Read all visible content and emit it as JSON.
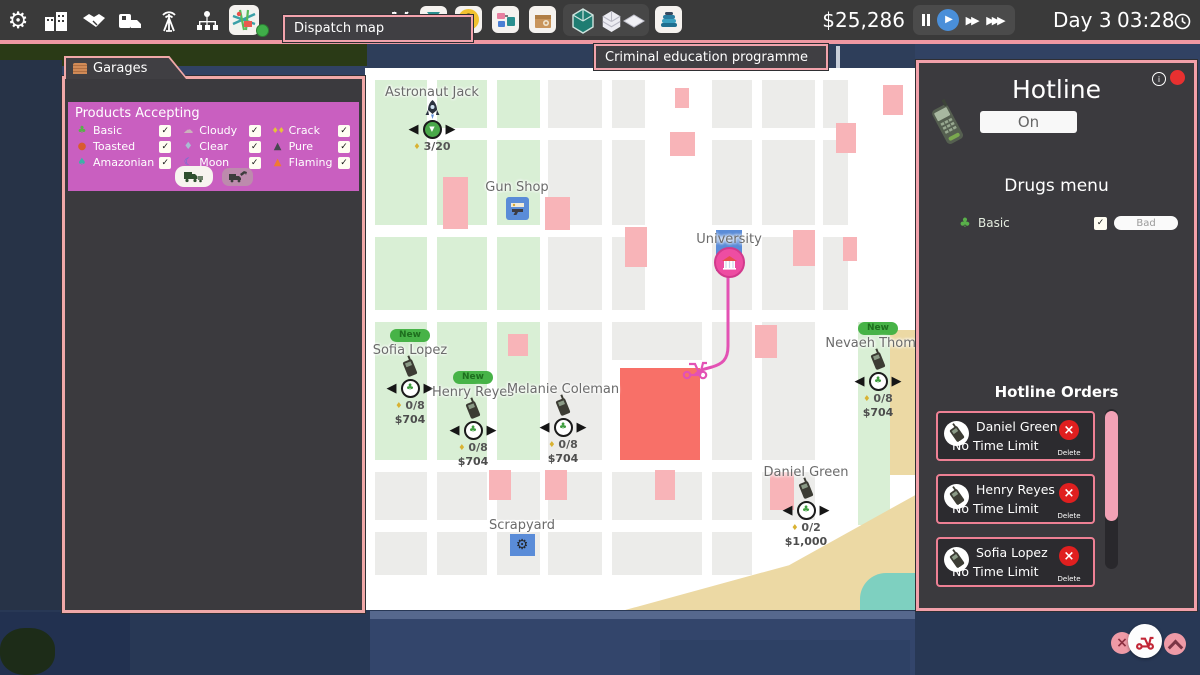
{
  "toolbar": {
    "money": "$25,286",
    "day": "Day 3",
    "time": "03:28",
    "dispatch_tooltip": "Dispatch map"
  },
  "map_tooltip": "Criminal education programme",
  "garage_panel": {
    "title": "Garages",
    "section_title": "Products Accepting",
    "products": [
      {
        "label": "Basic",
        "checked": true
      },
      {
        "label": "Toasted",
        "checked": true
      },
      {
        "label": "Amazonian",
        "checked": true
      },
      {
        "label": "Cloudy",
        "checked": true
      },
      {
        "label": "Clear",
        "checked": true
      },
      {
        "label": "Moon",
        "checked": true
      },
      {
        "label": "Crack",
        "checked": true
      },
      {
        "label": "Pure",
        "checked": true
      },
      {
        "label": "Flaming",
        "checked": true
      }
    ]
  },
  "map": {
    "locations": {
      "astronaut": {
        "name": "Astronaut Jack",
        "count": "3/20"
      },
      "gun_shop": {
        "name": "Gun Shop"
      },
      "university": {
        "name": "University"
      },
      "scrapyard": {
        "name": "Scrapyard"
      }
    },
    "customers": [
      {
        "name": "Sofia Lopez",
        "badge": "New",
        "count": "0/8",
        "price": "$704"
      },
      {
        "name": "Henry Reyes",
        "badge": "New",
        "count": "0/8",
        "price": "$704"
      },
      {
        "name": "Melanie Coleman",
        "count": "0/8",
        "price": "$704"
      },
      {
        "name": "Nevaeh Thomas",
        "badge": "New",
        "count": "0/8",
        "price": "$704"
      },
      {
        "name": "Daniel Green",
        "count": "0/2",
        "price": "$1,000"
      }
    ]
  },
  "hotline": {
    "title": "Hotline",
    "toggle": "On",
    "menu_title": "Drugs menu",
    "drug": {
      "label": "Basic",
      "quality": "Bad",
      "checked": true
    },
    "orders_title": "Hotline Orders",
    "orders": [
      {
        "name": "Daniel Green",
        "time": "No Time Limit",
        "action": "Delete"
      },
      {
        "name": "Henry Reyes",
        "time": "No Time Limit",
        "action": "Delete"
      },
      {
        "name": "Sofia Lopez",
        "time": "No Time Limit",
        "action": "Delete"
      }
    ]
  },
  "icons": {
    "settings": "⚙",
    "radiation": "☢",
    "leaf": "♣",
    "amazonian": "♠",
    "toasted": "●",
    "cloudy": "☁",
    "clear": "♦",
    "moon": "☾",
    "crack": "♦♦",
    "pure": "▲",
    "flaming": "▲",
    "arrow_left": "◀",
    "arrow_right": "▶",
    "play": "▶",
    "fast_forward": "▶▶",
    "fastest_forward": "▶▶▶",
    "close": "×",
    "check": "✓",
    "down_arrow": "▼",
    "info": "i",
    "unit": "♦"
  },
  "colors": {
    "accent_pink": "#f2a3ac",
    "magenta": "#c95fc0",
    "panel_dark": "#3b3a3e",
    "map_green": "#d9efd5",
    "map_pink": "#f8b4b8",
    "map_red": "#f87068",
    "badge_green": "#47b347",
    "route_pink": "#e352b4"
  }
}
